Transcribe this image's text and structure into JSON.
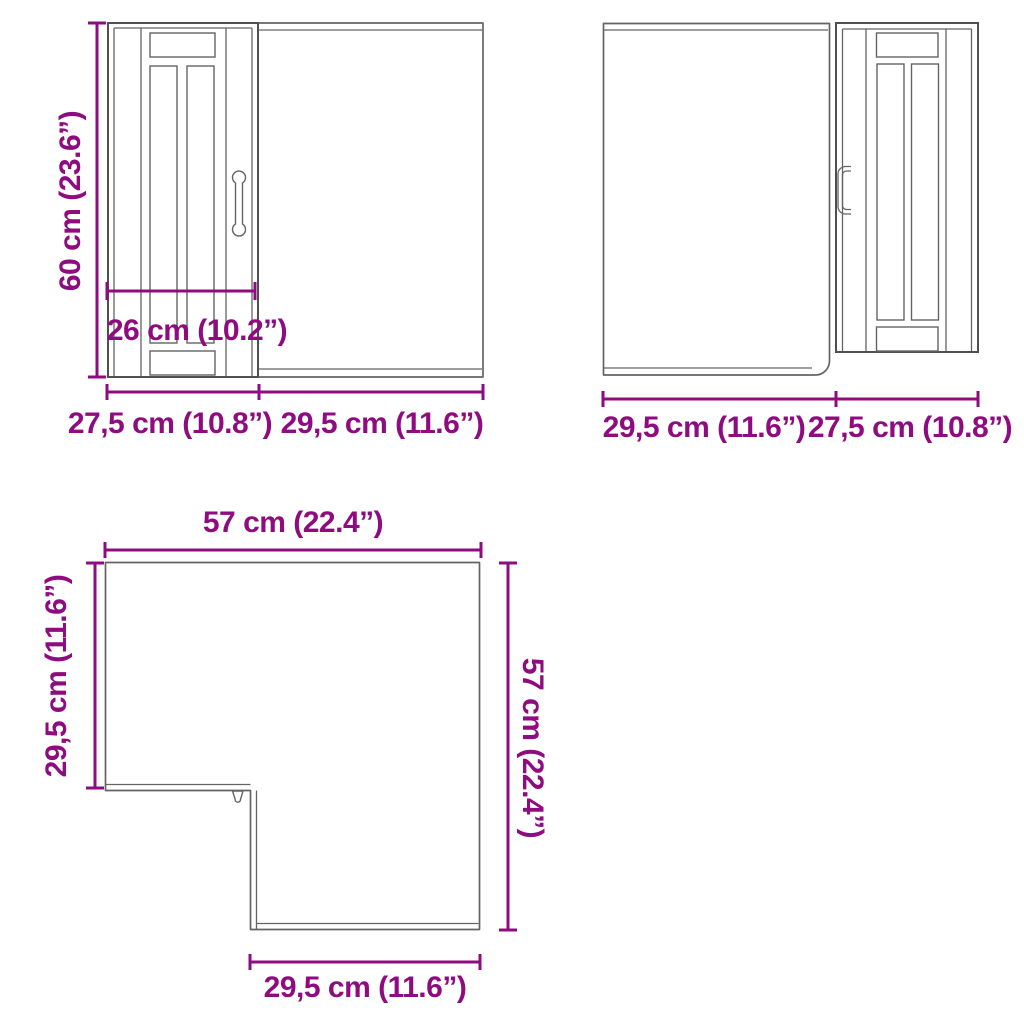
{
  "colors": {
    "accent": "#8E0C7F",
    "cabinet_line": "#646464",
    "background": "#FFFFFF"
  },
  "views": {
    "front_left": {
      "height_label": "60 cm (23.6”)",
      "inner_width_label": "26 cm (10.2”)",
      "bottom_left_label": "27,5 cm (10.8”)",
      "bottom_right_label": "29,5 cm (11.6”)"
    },
    "front_right": {
      "bottom_left_label": "29,5 cm (11.6”)",
      "bottom_right_label": "27,5 cm (10.8”)"
    },
    "top_view": {
      "top_label": "57 cm (22.4”)",
      "left_label": "29,5 cm (11.6”)",
      "right_label": "57 cm (22.4”)",
      "bottom_label": "29,5 cm (11.6”)"
    }
  }
}
